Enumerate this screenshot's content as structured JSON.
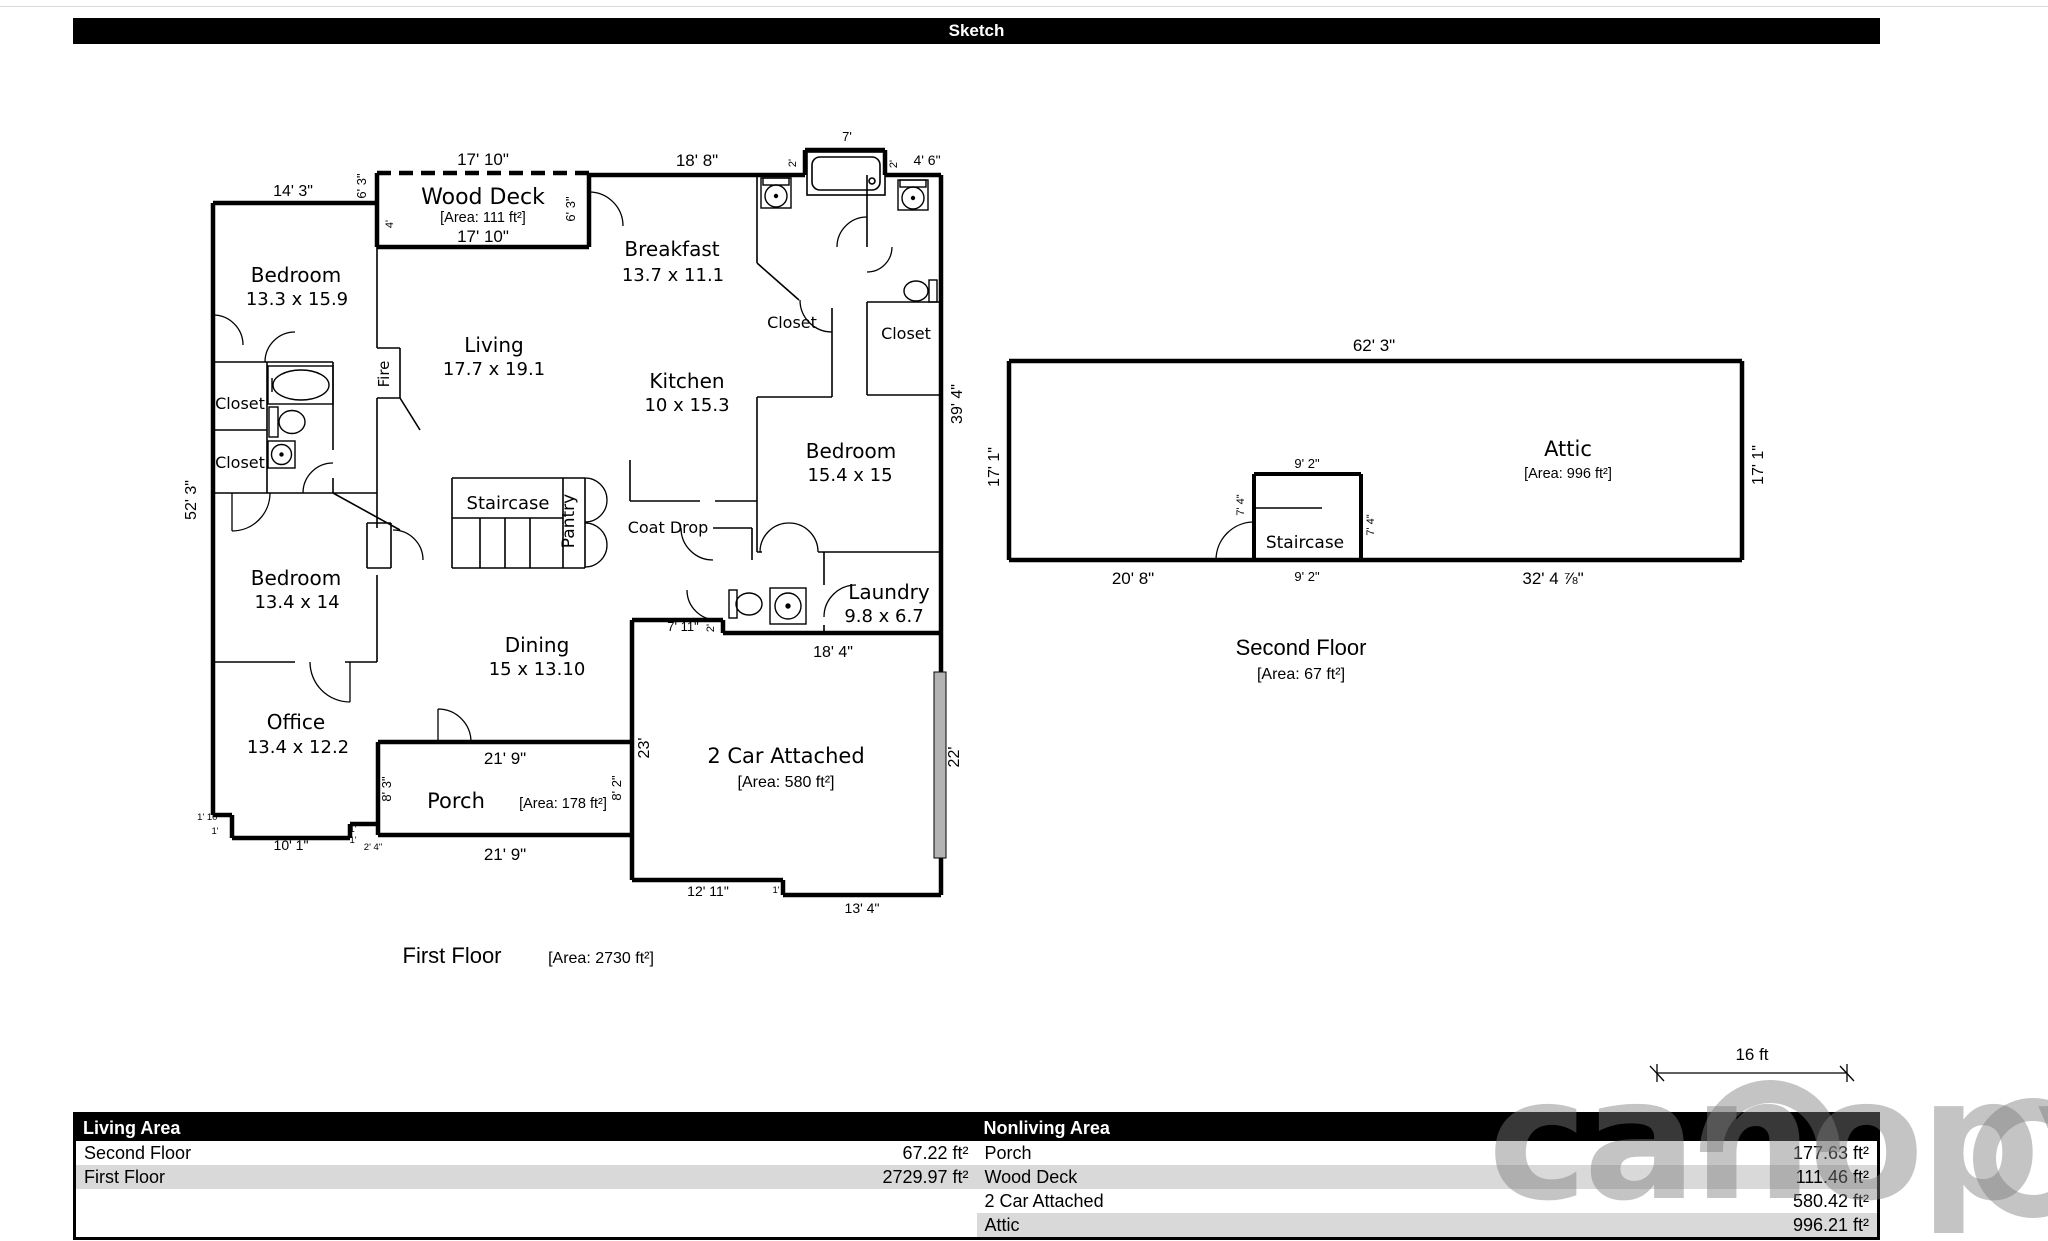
{
  "title": "Sketch",
  "watermark": "canopy",
  "scale": {
    "label": "16 ft"
  },
  "colors": {
    "row_alt": "#d9d9d9",
    "garage_door": "#b3b3b3"
  },
  "ff": {
    "caption": "First Floor",
    "caption_area": "[Area: 2730 ft²]",
    "deck": {
      "name": "Wood Deck",
      "area": "[Area: 111 ft²]",
      "w_top": "17' 10\"",
      "w_in": "17' 10\"",
      "h_left": "6' 3\"",
      "h_right": "6' 3\"",
      "inner4": "4'"
    },
    "rooms": {
      "bedroom1": {
        "n": "Bedroom",
        "d": "13.3 x 15.9"
      },
      "breakfast": {
        "n": "Breakfast",
        "d": "13.7 x 11.1"
      },
      "living": {
        "n": "Living",
        "d": "17.7 x 19.1"
      },
      "kitchen": {
        "n": "Kitchen",
        "d": "10 x 15.3"
      },
      "bedroom2": {
        "n": "Bedroom",
        "d": "15.4 x 15"
      },
      "bedroom3": {
        "n": "Bedroom",
        "d": "13.4 x 14"
      },
      "laundry": {
        "n": "Laundry",
        "d": "9.8 x 6.7"
      },
      "dining": {
        "n": "Dining",
        "d": "15 x 13.10"
      },
      "office": {
        "n": "Office",
        "d": "13.4 x 12.2"
      },
      "porch": {
        "n": "Porch",
        "area": "[Area: 178 ft²]"
      },
      "garage": {
        "n": "2 Car Attached",
        "area": "[Area: 580 ft²]"
      }
    },
    "labels": {
      "closet": "Closet",
      "fire": "Fire",
      "staircase": "Staircase",
      "pantry": "Pantry",
      "coat_drop": "Coat Drop"
    },
    "dims": {
      "d14_3": "14' 3\"",
      "d18_8": "18' 8\"",
      "d7": "7'",
      "d2a": "2'",
      "d2b": "2'",
      "d4_6": "4' 6\"",
      "d39_4": "39' 4\"",
      "d52_3": "52' 3\"",
      "d7_11": "7' 11\"",
      "d2c": "2'",
      "d18_4": "18' 4\"",
      "d23": "23'",
      "d22": "22'",
      "d12_11": "12' 11\"",
      "d1a": "1'",
      "d13_4": "13' 4\"",
      "d21_9t": "21' 9\"",
      "d21_9b": "21' 9\"",
      "d8_3": "8' 3\"",
      "d8_2": "8' 2\"",
      "d1_10": "1' 10\"",
      "d1b": "1'",
      "d10_1": "10' 1\"",
      "d1c": "1'",
      "d1d": "1'",
      "d2_4": "2' 4\""
    }
  },
  "sf": {
    "caption": "Second Floor",
    "caption_area": "[Area: 67 ft²]",
    "attic": {
      "n": "Attic",
      "area": "[Area: 996 ft²]"
    },
    "staircase": "Staircase",
    "dims": {
      "d62_3": "62' 3\"",
      "d17_1r": "17' 1\"",
      "d17_1l": "17' 1\"",
      "d9_2t": "9' 2\"",
      "d9_2b": "9' 2\"",
      "d7_4l": "7' 4\"",
      "d7_4r": "7' 4\"",
      "d20_8": "20' 8\"",
      "d32_4": "32' 4 ⅞\""
    }
  },
  "table": {
    "living": {
      "header": "Living Area",
      "rows": [
        {
          "label": "Second Floor",
          "value": "67.22 ft²"
        },
        {
          "label": "First Floor",
          "value": "2729.97 ft²"
        }
      ]
    },
    "nonliving": {
      "header": "Nonliving Area",
      "rows": [
        {
          "label": "Porch",
          "value": "177.63 ft²"
        },
        {
          "label": "Wood Deck",
          "value": "111.46 ft²"
        },
        {
          "label": "2 Car Attached",
          "value": "580.42 ft²"
        },
        {
          "label": "Attic",
          "value": "996.21 ft²"
        }
      ]
    }
  }
}
